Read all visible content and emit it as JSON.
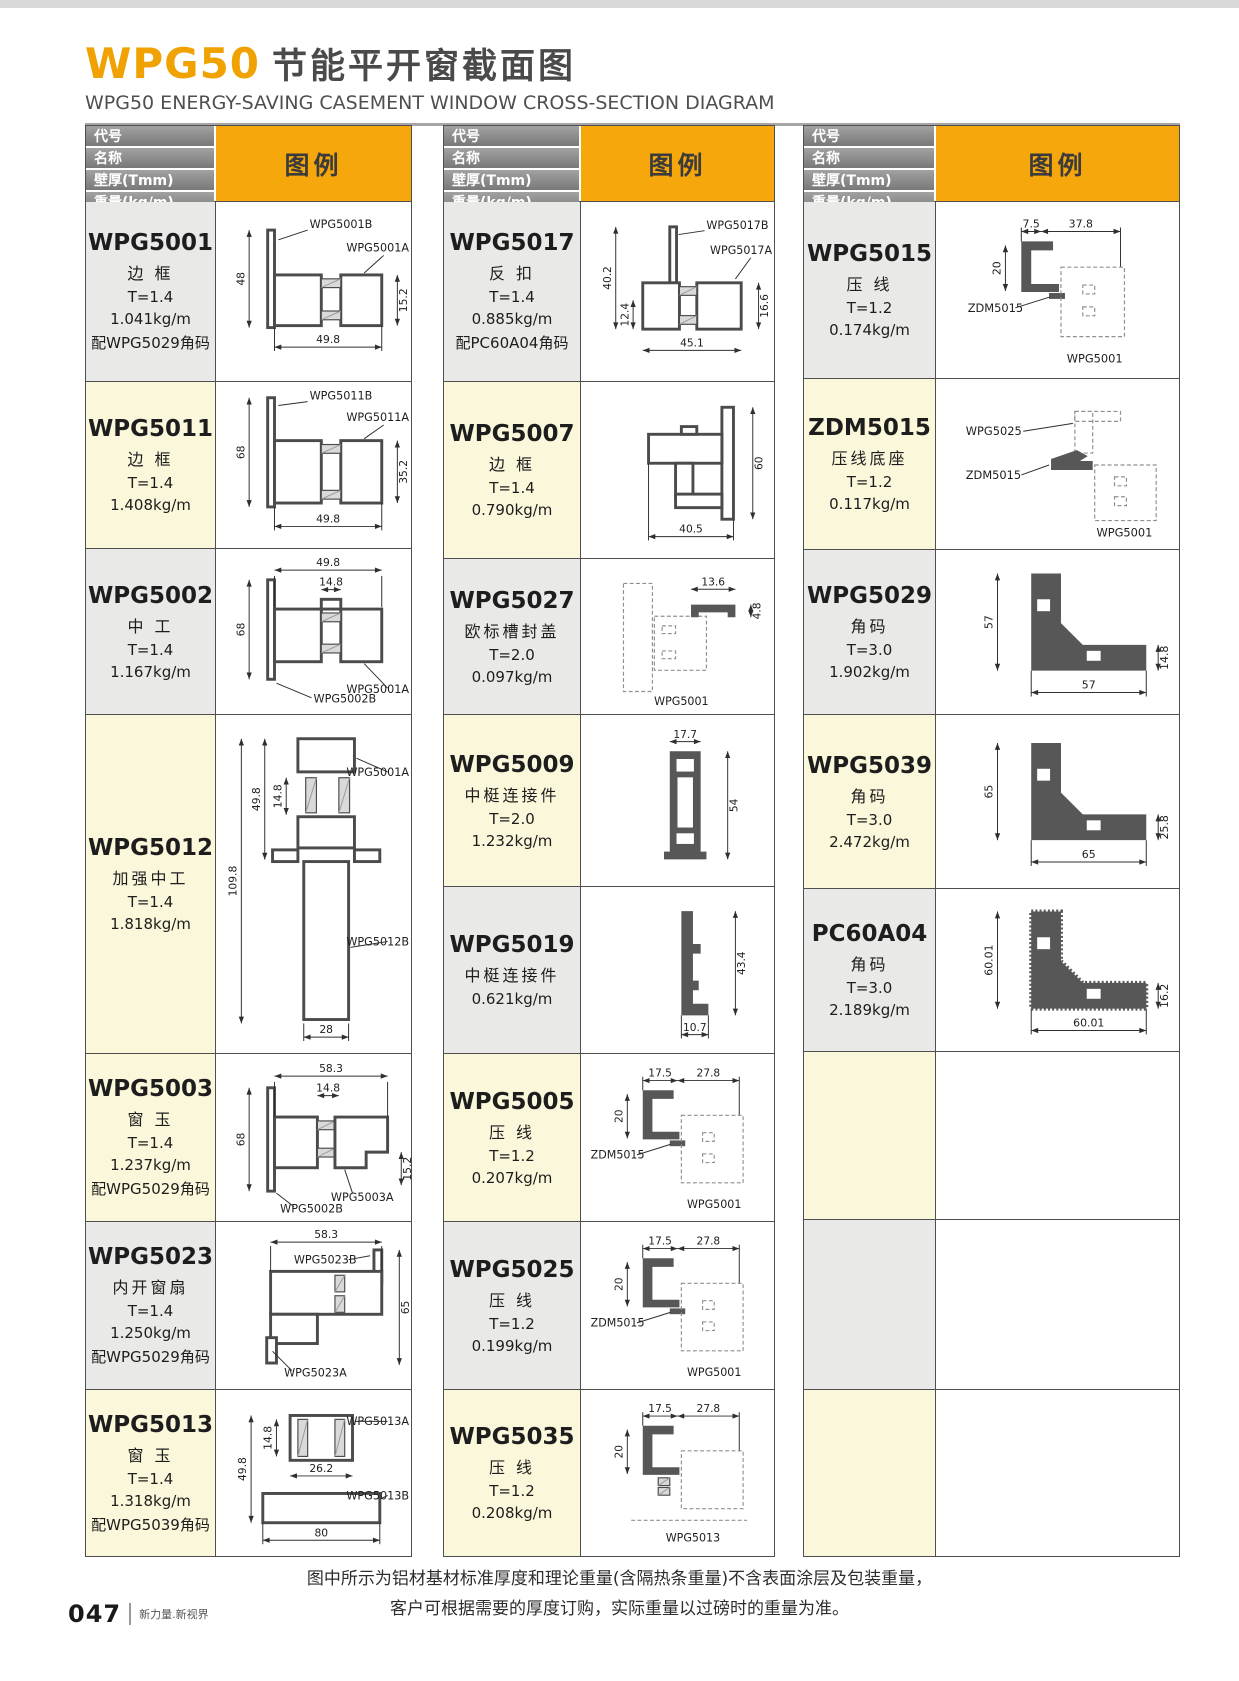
{
  "page": {
    "title_code": "WPG50",
    "title_cn": "节能平开窗截面图",
    "subtitle": "WPG50 ENERGY-SAVING CASEMENT WINDOW CROSS-SECTION DIAGRAM",
    "note_line1": "图中所示为铝材基材标准厚度和理论重量(含隔热条重量)不含表面涂层及包装重量，",
    "note_line2": "客户可根据需要的厚度订购，实际重量以过磅时的重量为准。",
    "page_number": "047",
    "tagline": "新力量.新视界"
  },
  "table_header": {
    "rows": [
      "代号",
      "名称",
      "壁厚(Tmm)",
      "重量(kg/m)"
    ],
    "legend": "图例"
  },
  "colors": {
    "accent": "#F5A70C",
    "title_orange": "#F0A202",
    "header_gray": "#8C8C8C",
    "row_yellow": "#FBF7DA",
    "row_gray": "#E9E9E7"
  },
  "columns": [
    {
      "rows": [
        {
          "code": "WPG5001",
          "name": "边 框",
          "thickness": "T=1.4",
          "weight": "1.041kg/m",
          "note": "配WPG5029角码",
          "shade": "gray",
          "diagram": {
            "shape": "frame5001",
            "dims": {
              "left": "48",
              "bottom": "49.8",
              "right": "15.2"
            },
            "labels": [
              "WPG5001B",
              "WPG5001A"
            ]
          }
        },
        {
          "code": "WPG5011",
          "name": "边 框",
          "thickness": "T=1.4",
          "weight": "1.408kg/m",
          "shade": "yellow",
          "diagram": {
            "shape": "frame5011",
            "dims": {
              "left": "68",
              "right": "35.2",
              "bottom": "49.8"
            },
            "labels": [
              "WPG5011B",
              "WPG5011A"
            ]
          }
        },
        {
          "code": "WPG5002",
          "name": "中 工",
          "thickness": "T=1.4",
          "weight": "1.167kg/m",
          "shade": "gray",
          "diagram": {
            "shape": "mull5002",
            "dims": {
              "top": "49.8",
              "inner": "14.8",
              "left": "68"
            },
            "labels": [
              "WPG5002B",
              "WPG5001A"
            ]
          }
        },
        {
          "code": "WPG5012",
          "name": "加强中工",
          "thickness": "T=1.4",
          "weight": "1.818kg/m",
          "shade": "yellow",
          "diagram": {
            "shape": "mull5012",
            "dims": {
              "outer": "109.8",
              "upper": "49.8",
              "inner": "14.8",
              "bottom": "28"
            },
            "labels": [
              "WPG5001A",
              "WPG5012B"
            ]
          }
        },
        {
          "code": "WPG5003",
          "name": "窗 玉",
          "thickness": "T=1.4",
          "weight": "1.237kg/m",
          "note": "配WPG5029角码",
          "shade": "yellow",
          "diagram": {
            "shape": "sash5003",
            "dims": {
              "top": "58.3",
              "inner": "14.8",
              "left": "68",
              "right": "15.2"
            },
            "labels": [
              "WPG5003A",
              "WPG5002B"
            ]
          }
        },
        {
          "code": "WPG5023",
          "name": "内开窗扇",
          "thickness": "T=1.4",
          "weight": "1.250kg/m",
          "note": "配WPG5029角码",
          "shade": "gray",
          "diagram": {
            "shape": "sash5023",
            "dims": {
              "top": "58.3",
              "right": "65"
            },
            "labels": [
              "WPG5023B",
              "WPG5023A"
            ]
          }
        },
        {
          "code": "WPG5013",
          "name": "窗 玉",
          "thickness": "T=1.4",
          "weight": "1.318kg/m",
          "note": "配WPG5039角码",
          "shade": "yellow",
          "diagram": {
            "shape": "sash5013",
            "dims": {
              "inner": "14.8",
              "left": "49.8",
              "mid": "26.2",
              "bottom": "80"
            },
            "labels": [
              "WPG5013A",
              "WPG5013B"
            ]
          }
        }
      ]
    },
    {
      "rows": [
        {
          "code": "WPG5017",
          "name": "反 扣",
          "thickness": "T=1.4",
          "weight": "0.885kg/m",
          "note": "配PC60A04角码",
          "shade": "gray",
          "diagram": {
            "shape": "hook5017",
            "dims": {
              "left": "40.2",
              "inner": "12.4",
              "bottom": "45.1",
              "right": "16.6"
            },
            "labels": [
              "WPG5017B",
              "WPG5017A"
            ]
          }
        },
        {
          "code": "WPG5007",
          "name": "边 框",
          "thickness": "T=1.4",
          "weight": "0.790kg/m",
          "shade": "yellow",
          "diagram": {
            "shape": "step5007",
            "dims": {
              "right": "60",
              "bottom": "40.5"
            },
            "labels": []
          }
        },
        {
          "code": "WPG5027",
          "name": "欧标槽封盖",
          "thickness": "T=2.0",
          "weight": "0.097kg/m",
          "shade": "gray",
          "diagram": {
            "shape": "cap5027",
            "dims": {
              "top": "13.6",
              "right": "4.8"
            },
            "labels": [
              "WPG5001"
            ]
          }
        },
        {
          "code": "WPG5009",
          "name": "中梃连接件",
          "thickness": "T=2.0",
          "weight": "1.232kg/m",
          "shade": "yellow",
          "diagram": {
            "shape": "conn5009",
            "dims": {
              "top": "17.7",
              "right": "54"
            },
            "labels": []
          }
        },
        {
          "code": "WPG5019",
          "name": "中梃连接件",
          "weight": "0.621kg/m",
          "shade": "gray",
          "diagram": {
            "shape": "conn5019",
            "dims": {
              "right": "43.4",
              "bottom": "10.7"
            },
            "labels": []
          }
        },
        {
          "code": "WPG5005",
          "name": "压 线",
          "thickness": "T=1.2",
          "weight": "0.207kg/m",
          "shade": "yellow",
          "diagram": {
            "shape": "bead",
            "dims": {
              "d1": "17.5",
              "d2": "27.8",
              "h": "20"
            },
            "labels": [
              "ZDM5015",
              "WPG5001"
            ]
          }
        },
        {
          "code": "WPG5025",
          "name": "压 线",
          "thickness": "T=1.2",
          "weight": "0.199kg/m",
          "shade": "gray",
          "diagram": {
            "shape": "bead",
            "dims": {
              "d1": "17.5",
              "d2": "27.8",
              "h": "20"
            },
            "labels": [
              "ZDM5015",
              "WPG5001"
            ]
          }
        },
        {
          "code": "WPG5035",
          "name": "压 线",
          "thickness": "T=1.2",
          "weight": "0.208kg/m",
          "shade": "yellow",
          "diagram": {
            "shape": "bead35",
            "dims": {
              "d1": "17.5",
              "d2": "27.8",
              "h": "20"
            },
            "labels": [
              "WPG5013"
            ]
          }
        }
      ]
    },
    {
      "rows": [
        {
          "code": "WPG5015",
          "name": "压 线",
          "thickness": "T=1.2",
          "weight": "0.174kg/m",
          "shade": "gray",
          "diagram": {
            "shape": "bead",
            "dims": {
              "d1": "7.5",
              "d2": "37.8",
              "h": "20"
            },
            "labels": [
              "ZDM5015",
              "WPG5001"
            ]
          }
        },
        {
          "code": "ZDM5015",
          "name": "压线底座",
          "thickness": "T=1.2",
          "weight": "0.117kg/m",
          "shade": "yellow",
          "diagram": {
            "shape": "zdm",
            "dims": {},
            "labels": [
              "WPG5025",
              "ZDM5015",
              "WPG5001"
            ]
          }
        },
        {
          "code": "WPG5029",
          "name": "角码",
          "thickness": "T=3.0",
          "weight": "1.902kg/m",
          "shade": "gray",
          "diagram": {
            "shape": "corner",
            "dims": {
              "left": "57",
              "right": "14.8",
              "bottom": "57"
            },
            "labels": []
          }
        },
        {
          "code": "WPG5039",
          "name": "角码",
          "thickness": "T=3.0",
          "weight": "2.472kg/m",
          "shade": "yellow",
          "diagram": {
            "shape": "corner",
            "dims": {
              "left": "65",
              "right": "25.8",
              "bottom": "65"
            },
            "labels": []
          }
        },
        {
          "code": "PC60A04",
          "name": "角码",
          "thickness": "T=3.0",
          "weight": "2.189kg/m",
          "shade": "gray",
          "diagram": {
            "shape": "cornerSerr",
            "dims": {
              "left": "60.01",
              "right": "16.2",
              "bottom": "60.01"
            },
            "labels": []
          }
        },
        {
          "code": "",
          "shade": "yellow"
        },
        {
          "code": "",
          "shade": "gray"
        },
        {
          "code": "",
          "shade": "yellow"
        }
      ]
    }
  ]
}
